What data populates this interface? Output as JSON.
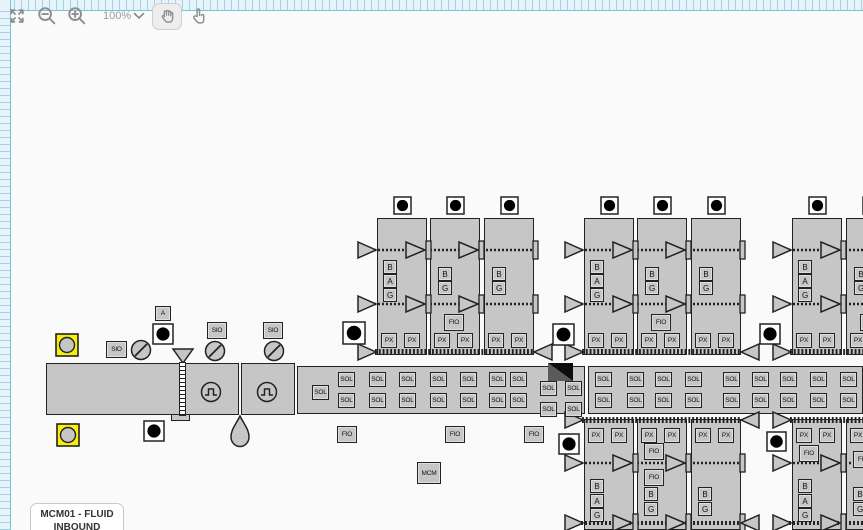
{
  "toolbar": {
    "zoom_level": "100%",
    "tools": [
      {
        "label": "fit-to-screen",
        "icon": "expand-arrows-icon"
      },
      {
        "label": "zoom-out",
        "icon": "magnifier-minus-icon"
      },
      {
        "label": "zoom-in",
        "icon": "magnifier-plus-icon"
      },
      {
        "label": "zoom-level",
        "icon": "chevron-down-icon"
      },
      {
        "label": "pan",
        "icon": "hand-icon",
        "active": true
      },
      {
        "label": "select",
        "icon": "pointer-finger-icon"
      }
    ]
  },
  "labels": {
    "sol": "SOL",
    "px": "PX",
    "fio": "FIO",
    "sio": "SIO",
    "mcm": "MCM",
    "a": "A",
    "b": "B",
    "g": "G"
  },
  "diagram_label": {
    "title": "MCM01 - FLUID INBOUND"
  },
  "colors": {
    "highlight_yellow": "#f8ee0a",
    "shape_fill": "#c6c6c6",
    "shape_border": "#222222",
    "ruler_background": "#e6f4fa",
    "ruler_tick": "#9ed5e6",
    "canvas_background": "#fafafa"
  }
}
